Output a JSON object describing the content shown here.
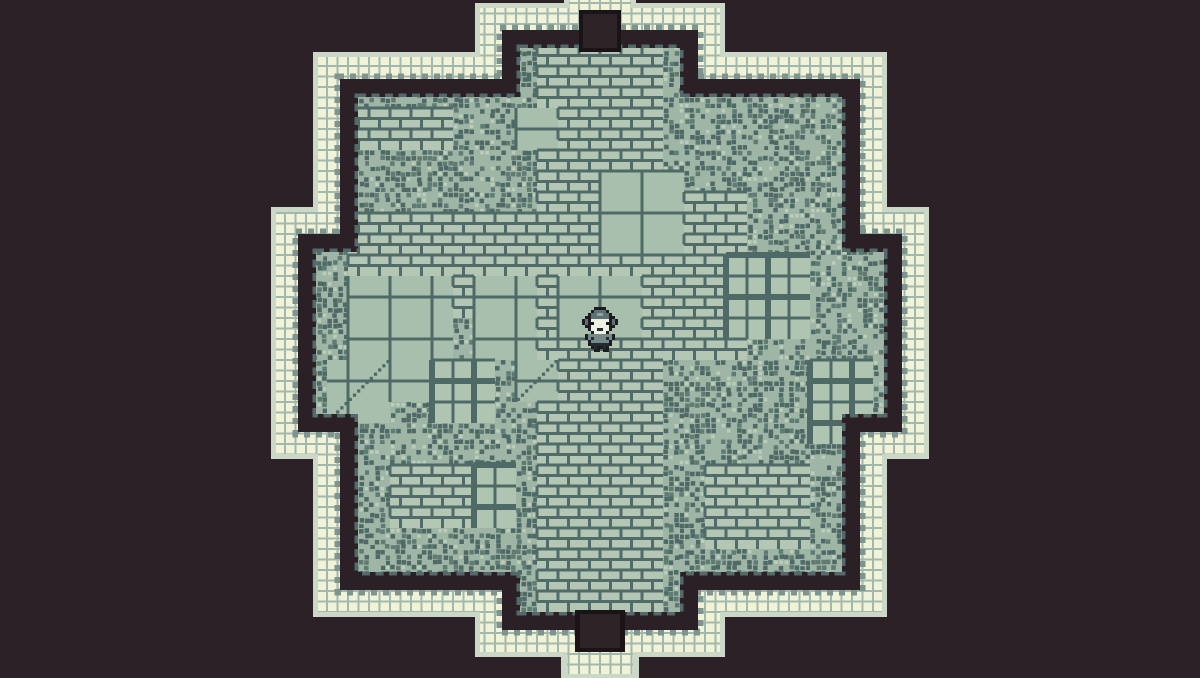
{
  "scene": {
    "name": "Monochrome dungeon chamber",
    "type": "top-down pixel-art room",
    "width": 1200,
    "height": 678,
    "aria_label": "Pixel-art dungeon room with stepped stone walls, doors at top and bottom, and a lone character standing at the center"
  },
  "palette": {
    "background": "#2b2127",
    "outline_light": "#cbd8c7",
    "wall_cream": "#f1f3d8",
    "wall_grid": "#a3b8ac",
    "teeth": "#7e958f",
    "wall_dark": "#2c2027",
    "slate_dash": "#54696a",
    "floor_base": "#9fb5a5",
    "tile_fill": "#a9bfae",
    "tile_grout": "#4f6a66",
    "brick_fill": "#b3c7b4",
    "brick_mortar": "#516c68",
    "cobble_dark": "#4f6a66",
    "cobble_mid": "#5f7b73",
    "cobble_light": "#bccdb9",
    "bigtile_fill": "#b0c4b2",
    "door_edge": "#1a1418",
    "door_hole": "#2e2327"
  },
  "room": {
    "wall_rects": [
      [
        480,
        8,
        240,
        644
      ],
      [
        318,
        57,
        564,
        555
      ],
      [
        276,
        212,
        648,
        242
      ]
    ],
    "band": {
      "outline_expand": 5,
      "teeth_inset": 20,
      "dark_inset": 22,
      "floor_inset": 40
    },
    "cream_grid_step": 10.5,
    "doors": {
      "top": {
        "bump_outline": [
          564,
          0,
          72,
          18
        ],
        "bump_cream": [
          569,
          0,
          62,
          14
        ],
        "recess_outer": [
          579,
          10,
          42,
          42
        ],
        "recess_inner": [
          583,
          14,
          34,
          34
        ]
      },
      "bottom": {
        "recess_outer": [
          575,
          610,
          50,
          42
        ],
        "recess_inner": [
          580,
          614,
          40,
          34
        ],
        "bump_outline": [
          561,
          650,
          78,
          28
        ],
        "bump_cream": [
          567,
          652,
          66,
          22
        ]
      }
    }
  },
  "tiles": {
    "size": 21,
    "origin": [
      264,
      3
    ],
    "default": "cobble",
    "patches": [
      {
        "type": "brick",
        "c": 13,
        "r": 2,
        "w": 6,
        "h": 27
      },
      {
        "type": "brick",
        "c": 4,
        "r": 10,
        "w": 9,
        "h": 5
      },
      {
        "type": "brick",
        "c": 18,
        "r": 13,
        "w": 5,
        "h": 4
      },
      {
        "type": "brick",
        "c": 19,
        "r": 9,
        "w": 4,
        "h": 5
      },
      {
        "type": "brick",
        "c": 4,
        "r": 5,
        "w": 5,
        "h": 2
      },
      {
        "type": "brick",
        "c": 21,
        "r": 22,
        "w": 5,
        "h": 4
      },
      {
        "type": "brick",
        "c": 6,
        "r": 22,
        "w": 4,
        "h": 3
      },
      {
        "type": "plain",
        "c": 4,
        "r": 13,
        "w": 5,
        "h": 6
      },
      {
        "type": "plain",
        "c": 10,
        "r": 13,
        "w": 3,
        "h": 4
      },
      {
        "type": "plain",
        "c": 16,
        "r": 8,
        "w": 4,
        "h": 4
      },
      {
        "type": "plain",
        "c": 12,
        "r": 5,
        "w": 2,
        "h": 2
      },
      {
        "type": "plain",
        "c": 14,
        "r": 13,
        "w": 4,
        "h": 3
      },
      {
        "type": "bigtile",
        "c": 22,
        "r": 12,
        "w": 4,
        "h": 4
      },
      {
        "type": "bigtile",
        "c": 26,
        "r": 17,
        "w": 3,
        "h": 4
      },
      {
        "type": "bigtile",
        "c": 8,
        "r": 17,
        "w": 3,
        "h": 3
      },
      {
        "type": "bigtile",
        "c": 10,
        "r": 22,
        "w": 2,
        "h": 3
      },
      {
        "type": "slope",
        "c": 3,
        "r": 17,
        "w": 3,
        "h": 3
      },
      {
        "type": "slope",
        "c": 12,
        "r": 17,
        "w": 2,
        "h": 2
      }
    ]
  },
  "player": {
    "x": 582,
    "y": 307,
    "scale": 3,
    "colors": {
      "o": "#1d1d20",
      "h": "#5d7172",
      "H": "#8fa39d",
      "f": "#edf1e2",
      "e": "#16161a",
      "b": "#75898a",
      "d": "#232c33"
    },
    "pixels": [
      "....oooo....",
      "...ohhhho...",
      "..ohhHHhho..",
      ".oohhhhhhoo.",
      "ohoffffffoho",
      "ohoeffffeoho",
      ".ooffffffoo.",
      "..offddffo..",
      "...offffo...",
      ".obbbbbbbbo.",
      ".obdbbbbdbo.",
      "..obbbbbbo..",
      "..oddddddo..",
      "...odoodo...",
      "....oo.oo..."
    ]
  }
}
